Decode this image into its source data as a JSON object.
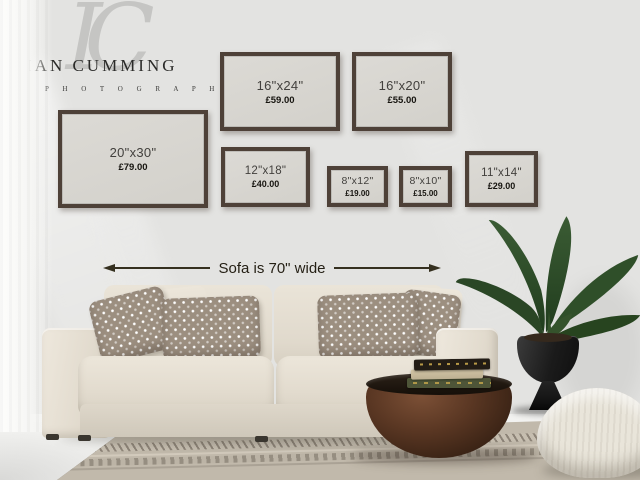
{
  "brand": {
    "monogram": "IC",
    "name": "IAN CUMMING",
    "subtitle": "P H O T O G R A P H Y"
  },
  "frames": [
    {
      "id": "20x30",
      "size": "20\"x30\"",
      "price": "£79.00"
    },
    {
      "id": "16x24",
      "size": "16\"x24\"",
      "price": "£59.00"
    },
    {
      "id": "16x20",
      "size": "16\"x20\"",
      "price": "£55.00"
    },
    {
      "id": "12x18",
      "size": "12\"x18\"",
      "price": "£40.00"
    },
    {
      "id": "8x12",
      "size": "8\"x12\"",
      "price": "£19.00"
    },
    {
      "id": "8x10",
      "size": "8\"x10\"",
      "price": "£15.00"
    },
    {
      "id": "11x14",
      "size": "11\"x14\"",
      "price": "£29.00"
    }
  ],
  "annotation": {
    "sofa_width_label": "Sofa is 70\" wide"
  },
  "scene": {
    "objects": [
      "curtain",
      "sofa",
      "patterned-pillows",
      "round-bronze-coffee-table",
      "stacked-books",
      "potted-bird-of-paradise-plant",
      "black-goblet-planter",
      "linen-pouf",
      "striped-area-rug"
    ],
    "colors": {
      "wall": "#e3e3e1",
      "floor": "#ebebe9",
      "frame_border": "#4e4138",
      "frame_mat": "#d7d5cf",
      "sofa_cream": "#e6e0d4",
      "pillow_taupe": "#9c8f80",
      "table_bronze": "#4a2d1d",
      "planter_black": "#1c1c1c",
      "plant_green": "#2e4a28",
      "pouf_linen": "#e9e5da",
      "rug_taupe": "#c1b9ab",
      "arrow_line": "#35301f"
    }
  }
}
